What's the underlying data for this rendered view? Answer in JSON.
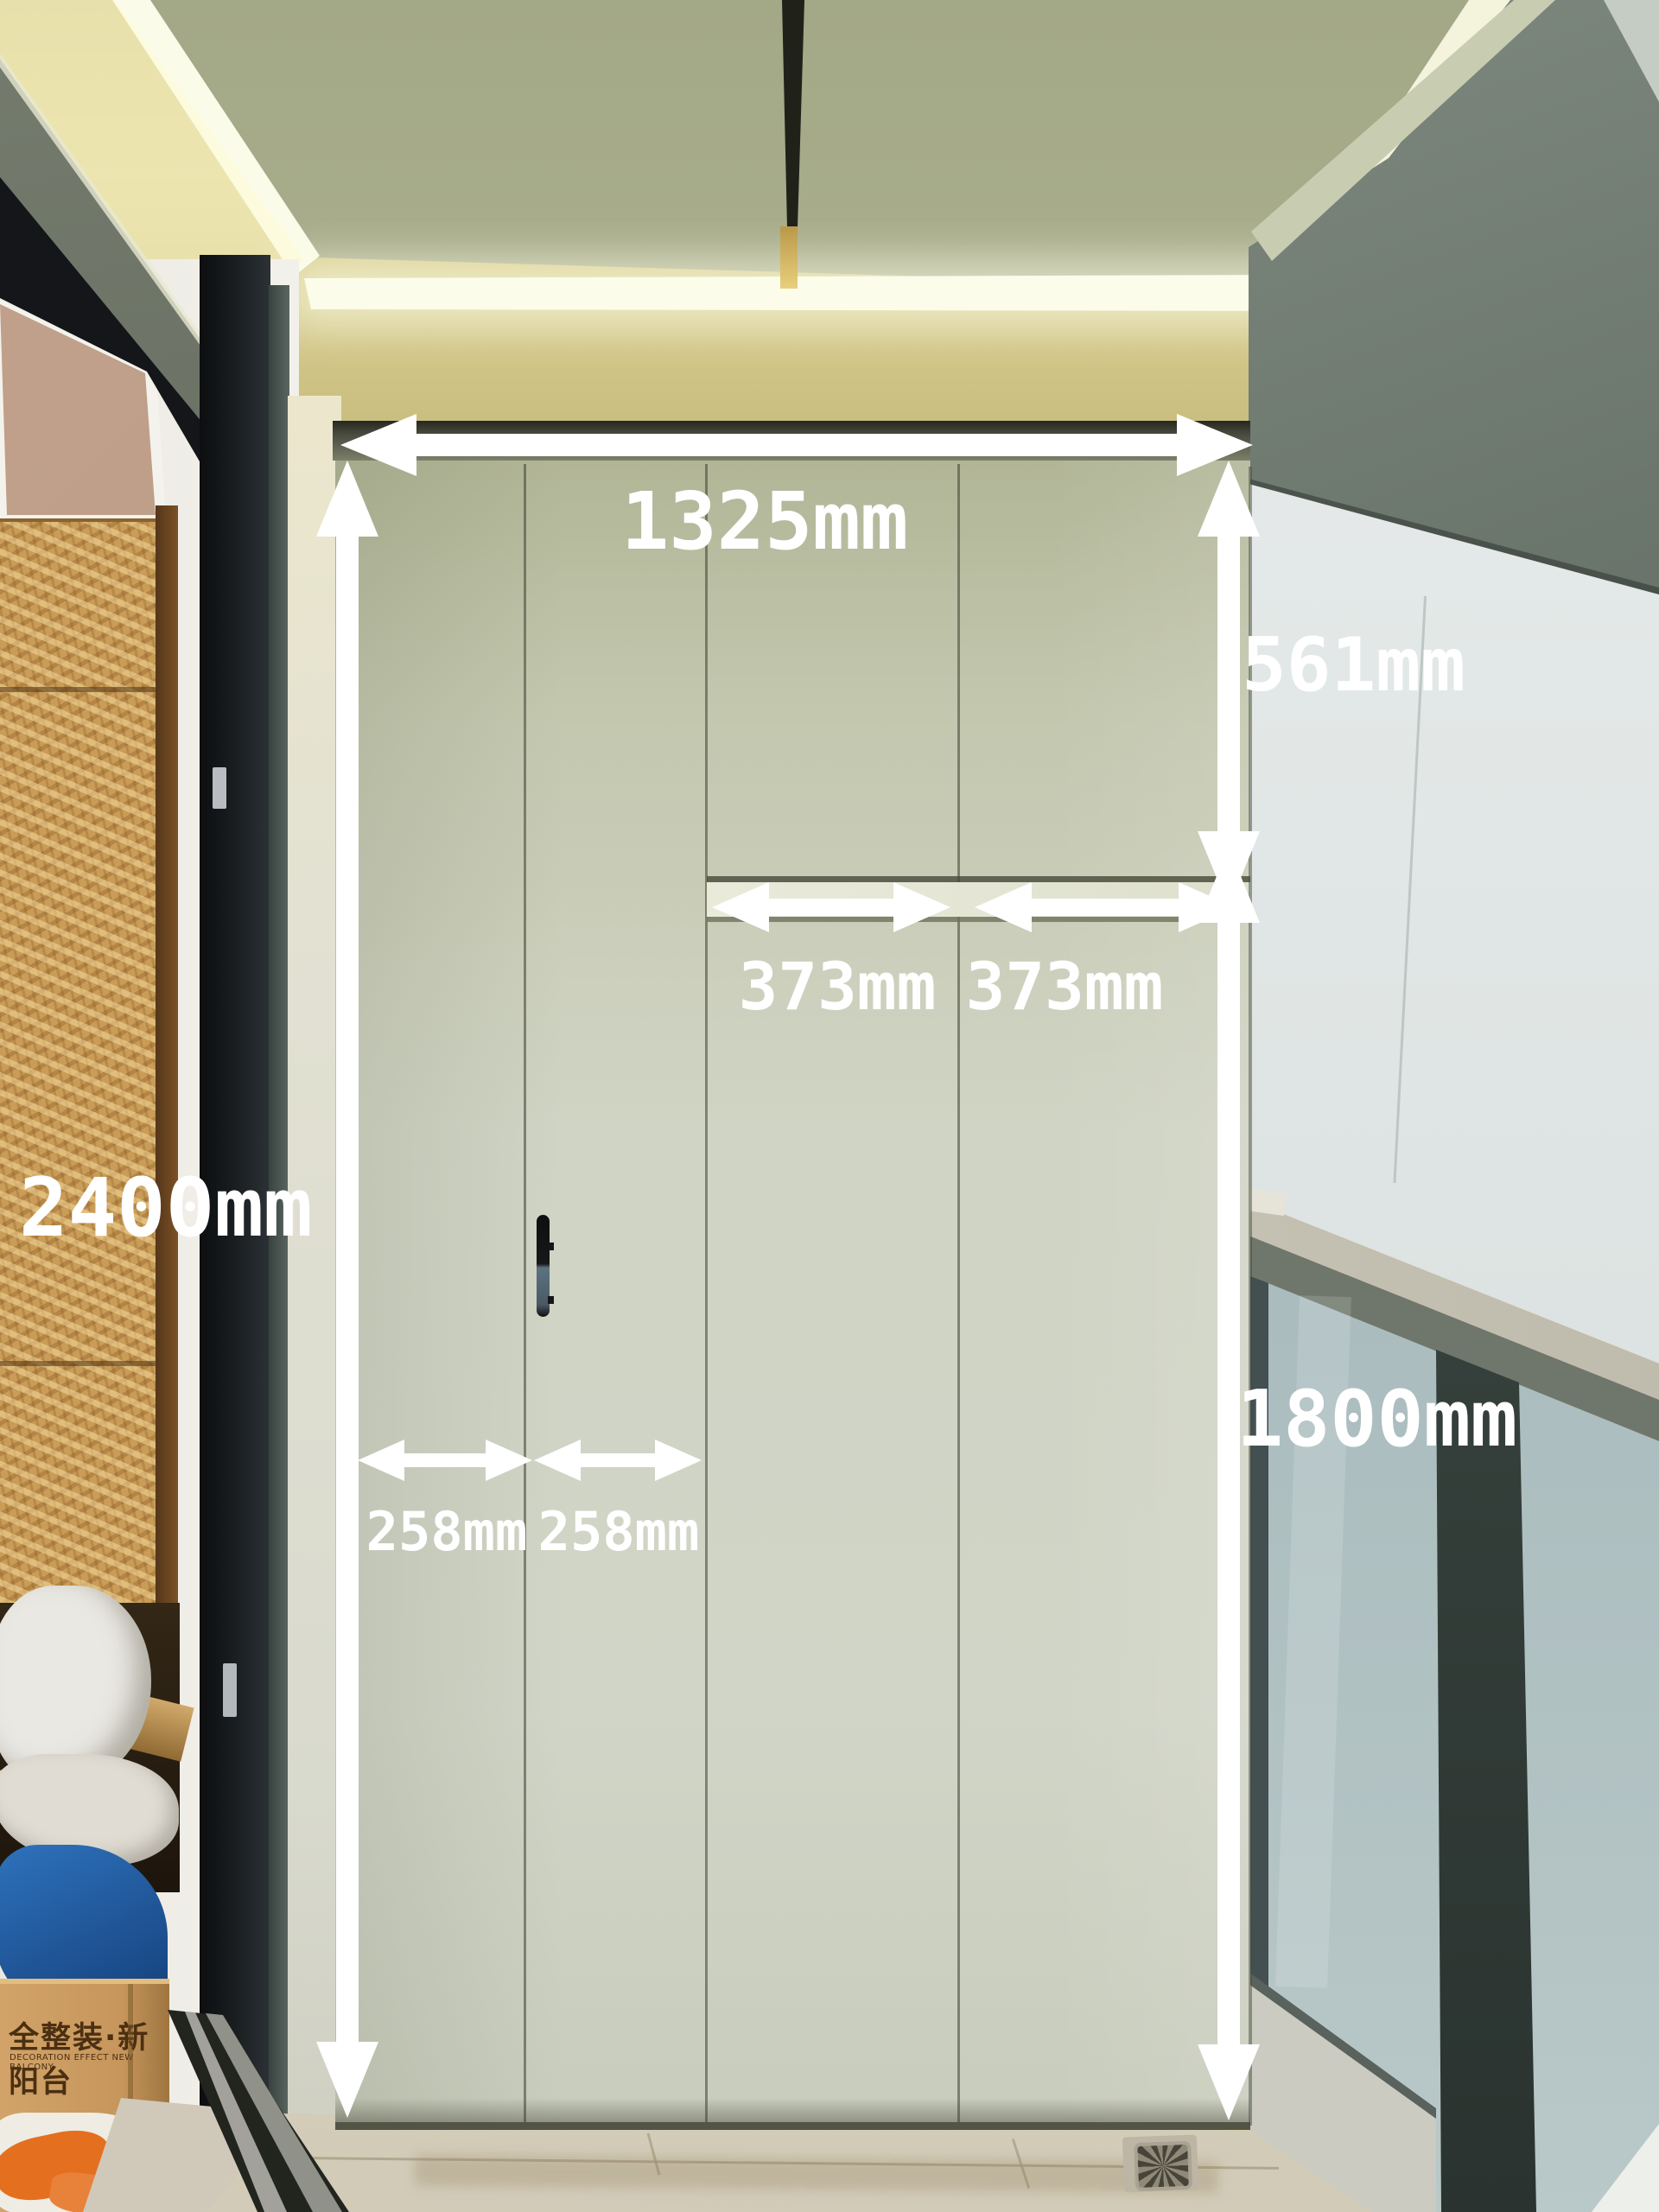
{
  "annotations": {
    "total_width": "1325mm",
    "upper_cabinet_height": "561mm",
    "upper_door_left_width": "373mm",
    "upper_door_right_width": "373mm",
    "cabinet_total_height": "2400mm",
    "tall_door_height": "1800mm",
    "folding_door_left_width": "258mm",
    "folding_door_right_width": "258mm"
  },
  "carton": {
    "label_cn": "全整装·新阳台",
    "label_en": "DECORATION EFFECT NEW BALCONY"
  },
  "colors": {
    "annotation_white": "#ffffff",
    "led_glow": "#fbfbe9",
    "ceiling_fascia": "#d5cb8e",
    "ceiling_panel": "#a9ad8b",
    "cabinet_door": "#cdd1c0",
    "overhang_dark": "#68726a",
    "exterior_wall": "#e0e5e4",
    "railing_glass": "#9db1b6",
    "osb_wood": "#c99c57",
    "door_frame_black": "#17191b",
    "blue_tarp": "#2a63ab",
    "carton_brown": "#c6965c",
    "floor_tile": "#d8d1c0"
  }
}
